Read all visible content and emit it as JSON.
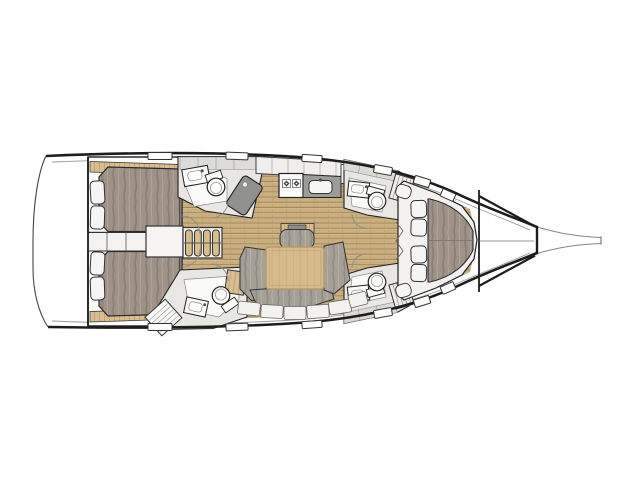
{
  "canvas": {
    "width": 640,
    "height": 479,
    "background": "#ffffff"
  },
  "diagram": {
    "type": "sailing-yacht-interior-floor-plan",
    "view": "top-down",
    "orientation": "bow-right-stern-left",
    "visible_features": {
      "double_berths": 3,
      "aft_cabins": 2,
      "forward_cabins": 1,
      "bathroom_compartments": 4,
      "toilets": 4,
      "sinks_bathroom": 4,
      "shower_stalls": 1,
      "galley_burners": 2,
      "galley_sinks": 1,
      "salon_tables": 1,
      "companionway_steps": 4,
      "pillows_forward_cabin": 4,
      "pillows_per_aft_cabin": 2,
      "settee_backrest_panels": 6,
      "deck_hatches": 12,
      "bowsprit": 1,
      "swim_platform": 1
    }
  },
  "colors": {
    "background": "#ffffff",
    "outline_dark": "#1d1d1d",
    "outline_mid": "#333333",
    "thin_line": "#8a8a8a",
    "wood_floor": "#c9ae80",
    "wood_floor_line": "#a58753",
    "wood_furniture": "#d7bd90",
    "mattress": "#9f9389",
    "mattress_streak": "#877a6e",
    "cushion": "#a49f97",
    "cushion_streak": "#8d887e",
    "room_gray": "#e8e7e4",
    "band_gray": "#dcdbd7",
    "counter_dark": "#9b9b99",
    "shower_dark": "#90908e",
    "white_furniture": "#f4f3f1",
    "table_wood": "#d6bc8d"
  }
}
